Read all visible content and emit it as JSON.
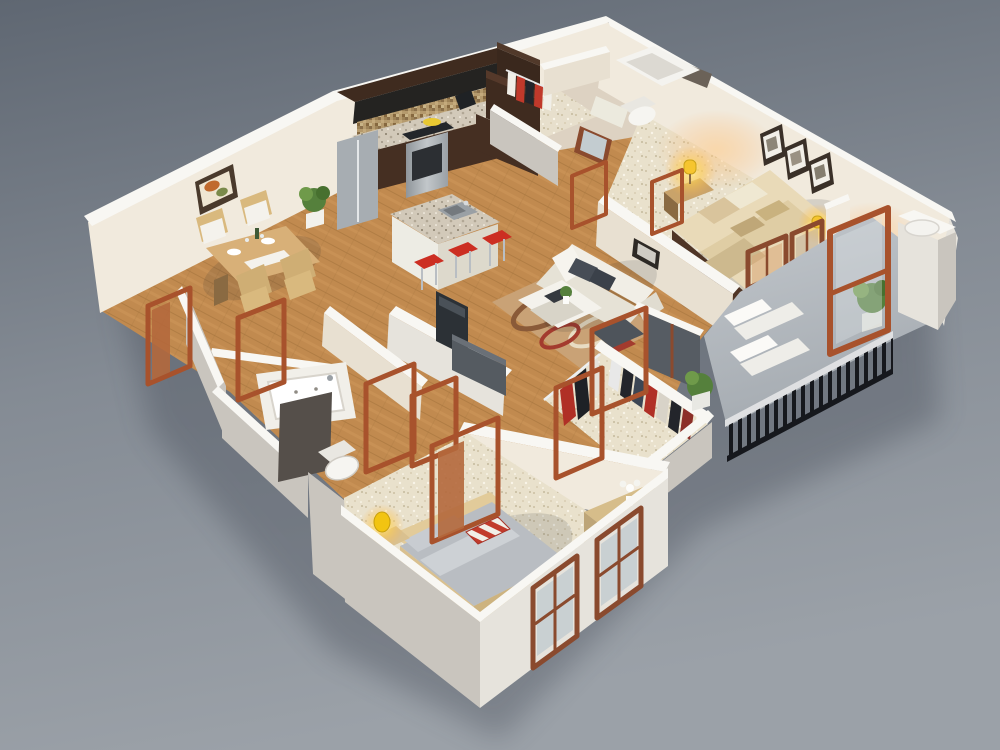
{
  "meta": {
    "description": "Photorealistic 3D isometric dollhouse-cutaway floor plan rendering of a two-bedroom, two-bathroom apartment with balcony, viewed from above on a gray studio backdrop",
    "visible_text": "none",
    "view": "isometric cutaway from above, apex corner at top center",
    "lighting": "warm lit table lamps in both bedrooms, neutral studio light"
  },
  "palette": {
    "bg_top": "#5f6772",
    "bg_bottom": "#9ba1a8",
    "ground_shadow": "#343b47",
    "wall_top": "#f8f7f3",
    "wall_inner": "#f1eadd",
    "wall_outer": "#e6e3dc",
    "wall_shade": "#c9c5be",
    "wood_floor": "#c18a4f",
    "carpet": "#e9e1cc",
    "balcony_floor": "#b2b8be",
    "cabinet_dark": "#3f2b1f",
    "granite": "#d2c9b9",
    "stainless": "#a7adb2",
    "island_base": "#edece4",
    "stool_red": "#cc2e22",
    "sofa_white": "#f1eee6",
    "pillow_gray": "#474d56",
    "rug_base": "#c9a276",
    "rug_swirl": "#8a5a38",
    "master_bed": "#e9dab8",
    "bed_frame_dark": "#4f3526",
    "bed2_gray": "#b9bdc2",
    "bed2_frame": "#d9c08f",
    "stripe_red": "#c23b2c",
    "door_frame": "#a8522c",
    "window_frame": "#8a4a2e",
    "glass": "#c3ccd0",
    "glass_dark": "#565c63",
    "railing": "#16181d",
    "lamp_yellow": "#ffd23f",
    "plant_green": "#55803c",
    "mirror_dark": "#554f4a",
    "dresser_wood": "#d6bd8a",
    "table_wood": "#d8b078"
  },
  "rooms": [
    {
      "name": "Kitchen",
      "floor": "hardwood",
      "furniture": [
        "L-shaped dark espresso cabinets",
        "mosaic tile backsplash",
        "granite countertops",
        "stainless steel refrigerator",
        "stainless range with oven",
        "black coffee maker",
        "curved granite island with double sink",
        "3 red bar stools"
      ]
    },
    {
      "name": "Dining Area",
      "floor": "hardwood",
      "furniture": [
        "light wood dining table with place settings",
        "4 wood chairs with white cushions",
        "framed artwork on wall",
        "potted plant"
      ]
    },
    {
      "name": "Living Room",
      "floor": "hardwood",
      "furniture": [
        "white three-seat sofa with dark gray cushions",
        "white coffee table with books and plant",
        "patterned swirl area rug",
        "flat-screen TV on partition wall",
        "dark media bench",
        "small dark wall picture"
      ]
    },
    {
      "name": "Master Bedroom",
      "floor": "cream carpet",
      "furniture": [
        "queen bed with beige bedding and four pillows",
        "dark wood bed frame",
        "wood nightstand",
        "lit yellow table lamp",
        "second lit lamp near window",
        "three framed pictures over bed",
        "glazed doors to balcony"
      ]
    },
    {
      "name": "Master Bathroom & Entry",
      "floor": "light tile",
      "furniture": [
        "bathtub with dark trim",
        "toilet",
        "vanity with leaning mirror",
        "entry closet with hanging clothes",
        "dark brown cabinet"
      ]
    },
    {
      "name": "Walk-in Closet",
      "floor": "cream carpet",
      "furniture": [
        "two white hanging rails",
        "assorted hanging clothes in red, black, white and gray"
      ]
    },
    {
      "name": "Second Bathroom",
      "floor": "hardwood",
      "furniture": [
        "jetted drop-in bathtub",
        "dark leaning vanity mirror",
        "toilet"
      ]
    },
    {
      "name": "Second Bedroom",
      "floor": "cream carpet",
      "furniture": [
        "bed with gray bedding",
        "red and white striped accent pillow",
        "light wood bed frame",
        "two lit yellow table lamps on nightstands",
        "wood dresser with white flowers",
        "two wood-framed windows"
      ]
    },
    {
      "name": "Balcony",
      "floor": "concrete",
      "furniture": [
        "two white lounge chairs",
        "potted plant",
        "black metal bar railing",
        "white column with round top",
        "open glazed wood door"
      ]
    },
    {
      "name": "Hallway",
      "floor": "hardwood",
      "furniture": [
        "multiple open orange-wood door frames"
      ]
    }
  ]
}
